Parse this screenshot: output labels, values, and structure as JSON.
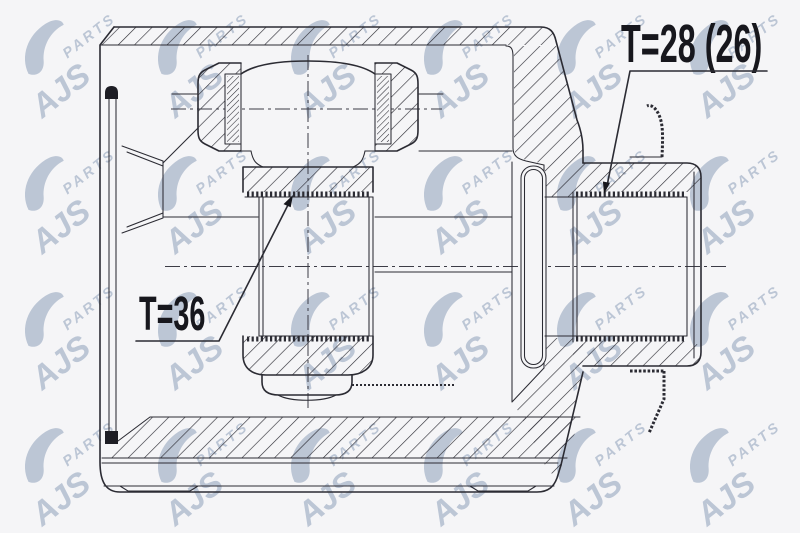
{
  "page": {
    "background_color": "#f5f5f7",
    "line_color": "#2b2b33",
    "label_color": "#17171d"
  },
  "labels": {
    "inner_spline_count": "T=36",
    "outer_spline_count": "T=28 (26)"
  },
  "watermark": {
    "brand": "AJS",
    "brand_sub": "PARTS",
    "color": "#8fa0bb"
  }
}
